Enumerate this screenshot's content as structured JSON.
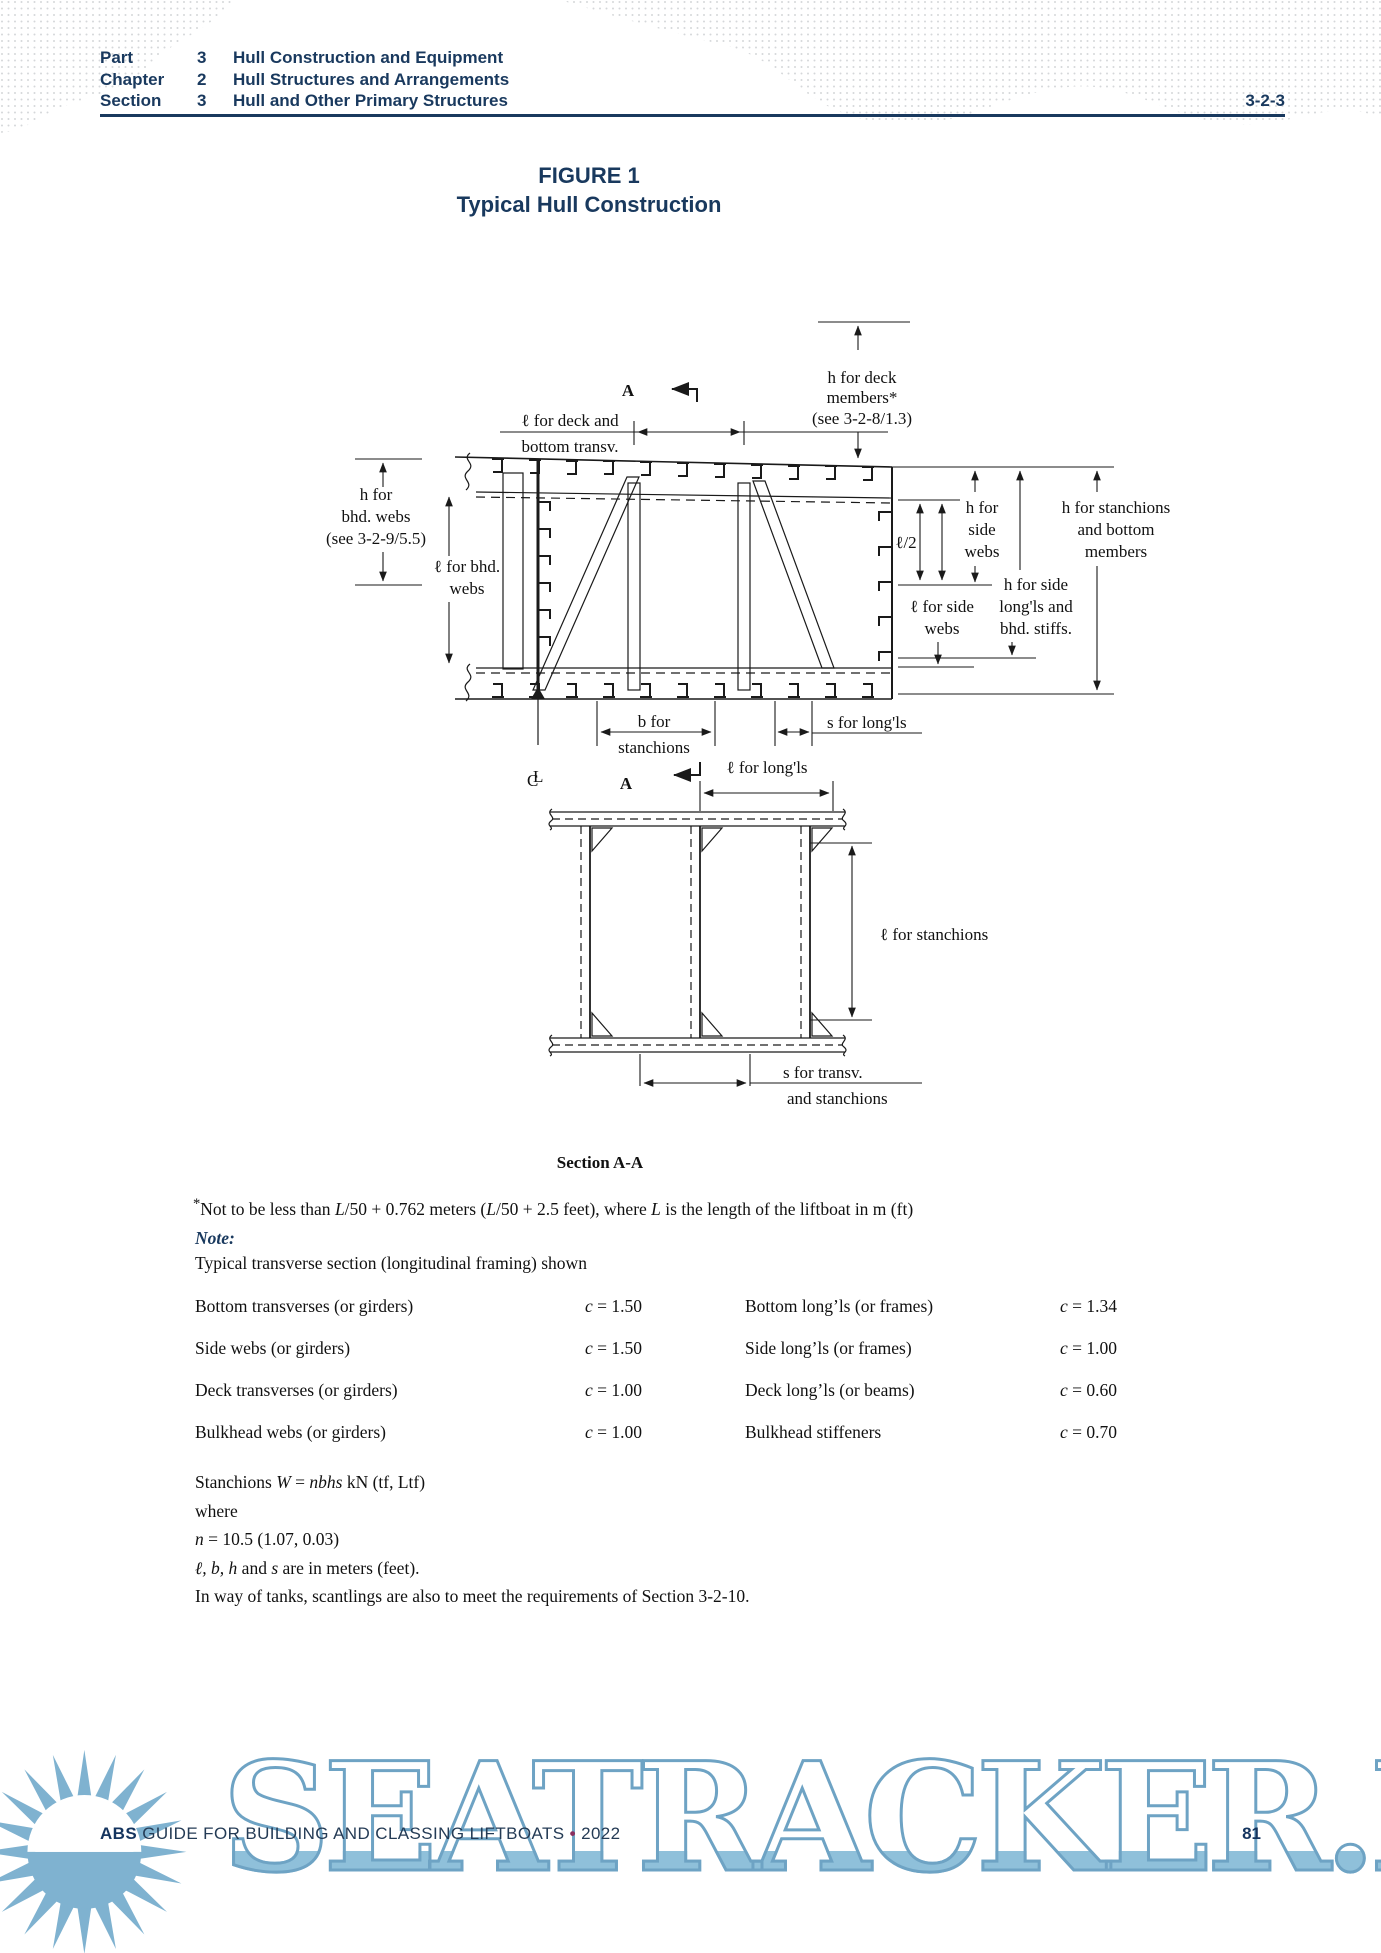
{
  "header": {
    "rows": [
      {
        "label": "Part",
        "num": "3",
        "title": "Hull Construction and Equipment"
      },
      {
        "label": "Chapter",
        "num": "2",
        "title": "Hull Structures and Arrangements"
      },
      {
        "label": "Section",
        "num": "3",
        "title": "Hull and Other Primary Structures"
      }
    ],
    "code": "3-2-3"
  },
  "figure": {
    "label": "FIGURE 1",
    "title": "Typical Hull Construction",
    "section_caption": "Section A-A"
  },
  "diagram": {
    "a_marker_top": "A",
    "a_marker_bottom": "A",
    "h_deck_members": [
      "h for deck",
      "members*",
      "(see 3-2-8/1.3)"
    ],
    "l_deck_transv": [
      "ℓ for deck and",
      "bottom transv."
    ],
    "h_bhd_webs": [
      "h for",
      "bhd. webs",
      "(see 3-2-9/5.5)"
    ],
    "l_bhd_webs": [
      "ℓ for bhd.",
      "webs"
    ],
    "l_over_2": "ℓ/2",
    "h_side_webs": [
      "h for",
      "side",
      "webs"
    ],
    "h_stanchions_bottom": [
      "h for stanchions",
      "and bottom",
      "members"
    ],
    "h_side_longls": [
      "h for side",
      "long'ls and",
      "bhd. stiffs."
    ],
    "l_side_webs": [
      "ℓ for side",
      "webs"
    ],
    "b_stanchions": [
      "b for",
      "stanchions"
    ],
    "s_longls": "s for long'ls",
    "centerline": {
      "c": "C",
      "l": "L"
    },
    "l_longls": "ℓ for long'ls",
    "l_stanchions": "ℓ for stanchions",
    "s_transv": [
      "s for transv.",
      "and stanchions"
    ]
  },
  "footnote": {
    "star": "*",
    "seg1": "Not to be less than ",
    "m1": "L",
    "seg2": "/50 + 0.762 meters (",
    "m2": "L",
    "seg3": "/50 + 2.5 feet), where ",
    "m3": "L",
    "seg4": " is the length of the liftboat in m (ft)"
  },
  "note": {
    "label": "Note:",
    "text": "Typical transverse section (longitudinal framing) shown"
  },
  "table": {
    "rows": [
      {
        "left_label": "Bottom transverses (or girders)",
        "left_sym": "c",
        "left_eq": " = ",
        "left_val": "1.50",
        "right_label": "Bottom long’ls (or frames)",
        "right_sym": "c",
        "right_eq": " = ",
        "right_val": "1.34"
      },
      {
        "left_label": "Side webs (or girders)",
        "left_sym": "c",
        "left_eq": " = ",
        "left_val": "1.50",
        "right_label": "Side long’ls (or frames)",
        "right_sym": "c",
        "right_eq": " = ",
        "right_val": "1.00"
      },
      {
        "left_label": "Deck transverses (or girders)",
        "left_sym": "c",
        "left_eq": " = ",
        "left_val": "1.00",
        "right_label": "Deck long’ls (or beams)",
        "right_sym": "c",
        "right_eq": " = ",
        "right_val": "0.60"
      },
      {
        "left_label": "Bulkhead webs (or girders)",
        "left_sym": "c",
        "left_eq": " = ",
        "left_val": "1.00",
        "right_label": "Bulkhead stiffeners",
        "right_sym": "c",
        "right_eq": " = ",
        "right_val": "0.70"
      }
    ]
  },
  "formulas": {
    "stanchions_prefix": "Stanchions ",
    "w": "W",
    "eq": " = ",
    "expr": "nbhs",
    "unit": " kN (tf, Ltf)",
    "where": "where",
    "n_sym": "n",
    "n_rest": " = 10.5 (1.07, 0.03)",
    "vars_sym": "ℓ, b, h",
    "vars_mid": " and ",
    "vars_s": "s",
    "vars_rest": " are in meters (feet).",
    "tanks": "In way of tanks, scantlings are also to meet the requirements of Section 3-2-10."
  },
  "footer": {
    "brand": "ABS",
    "text": " GUIDE FOR BUILDING AND CLASSING LIFTBOATS ",
    "bullet": "•",
    "year": " 2022",
    "page": "81"
  },
  "watermark": "SEATRACKER.RU",
  "colors": {
    "navy": "#19395e",
    "accent": "#8b2f5f",
    "watermark_fill": "#8fc0da",
    "watermark_stroke": "#6ea3c4"
  }
}
